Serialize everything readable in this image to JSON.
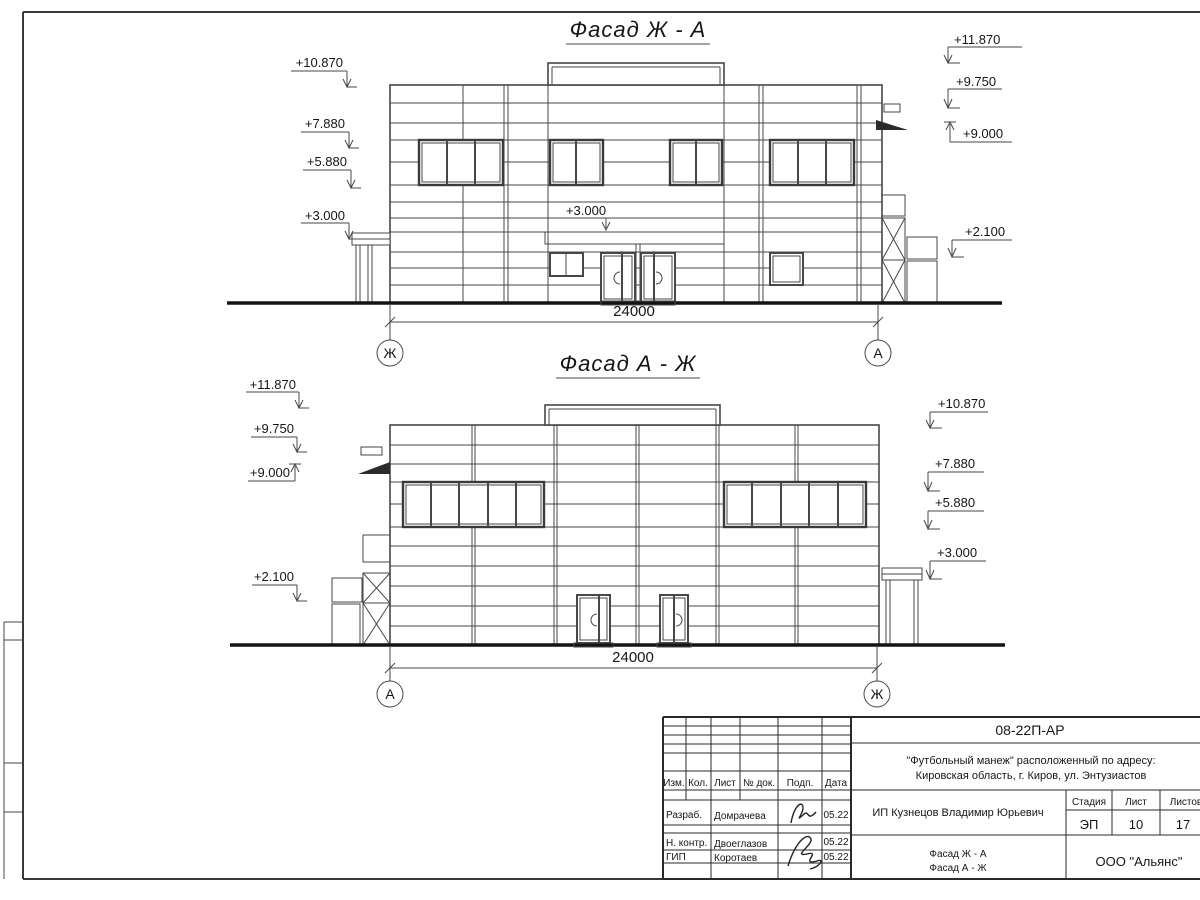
{
  "drawing": {
    "facade_top": {
      "title": "Фасад Ж - А",
      "dimension": "24000",
      "axis_left": "Ж",
      "axis_right": "А",
      "canopy_mark": "+3.000",
      "marks_left": [
        "+10.870",
        "+7.880",
        "+5.880",
        "+3.000"
      ],
      "marks_right": [
        "+11.870",
        "+9.750",
        "+9.000",
        "+2.100"
      ]
    },
    "facade_bottom": {
      "title": "Фасад А - Ж",
      "dimension": "24000",
      "axis_left": "А",
      "axis_right": "Ж",
      "marks_left": [
        "+11.870",
        "+9.750",
        "+9.000",
        "+2.100"
      ],
      "marks_right": [
        "+10.870",
        "+7.880",
        "+5.880",
        "+3.000"
      ]
    }
  },
  "title_block": {
    "doc_number": "08-22П-АР",
    "project_name_line1": "\"Футбольный манеж\" расположенный по адресу:",
    "project_name_line2": "Кировская область, г. Киров, ул. Энтузиастов",
    "client": "ИП Кузнецов Владимир Юрьевич",
    "columns": [
      "Изм.",
      "Кол.",
      "Лист",
      "№ док.",
      "Подп.",
      "Дата"
    ],
    "signature_rows": [
      {
        "role": "Разраб.",
        "name": "Домрачева",
        "date": "05.22"
      },
      {
        "role": "Н. контр.",
        "name": "Двоеглазов",
        "date": "05.22"
      },
      {
        "role": "ГИП",
        "name": "Коротаев",
        "date": "05.22"
      }
    ],
    "stage_label": "Стадия",
    "stage_value": "ЭП",
    "sheet_label": "Лист",
    "sheet_value": "10",
    "sheets_label": "Листов",
    "sheets_value": "17",
    "sheet_name_line1": "Фасад Ж - А",
    "sheet_name_line2": "Фасад А - Ж",
    "organization": "ООО \"Альянс\"",
    "colors": {
      "line": "#474747",
      "thick": "#141414",
      "background": "#ffffff"
    }
  }
}
